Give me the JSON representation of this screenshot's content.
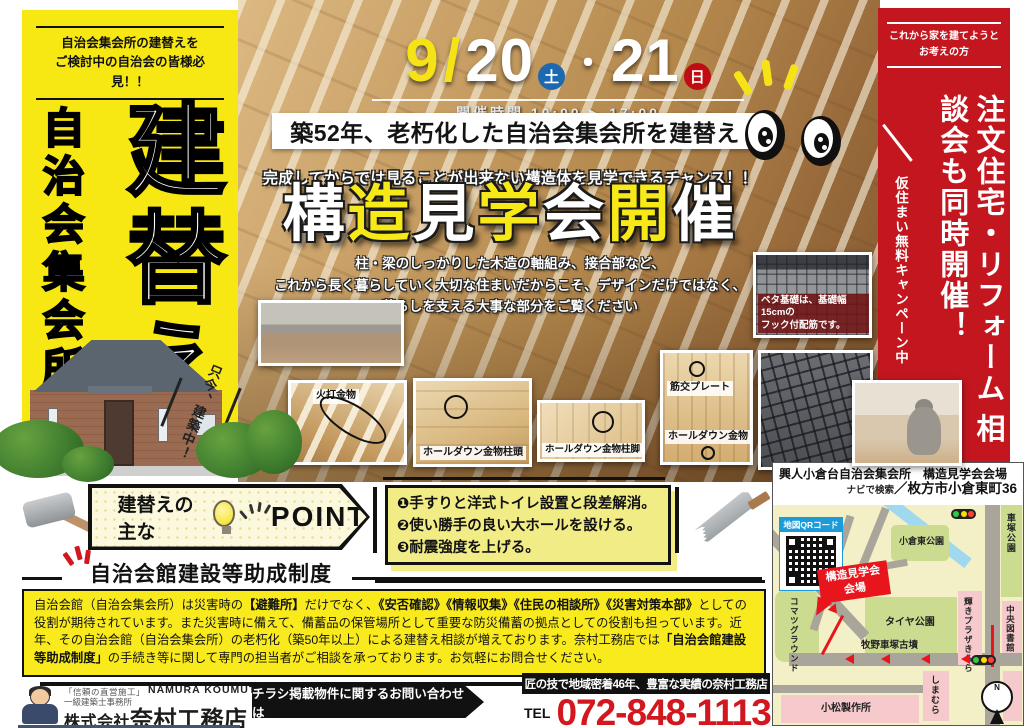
{
  "colors": {
    "banner_yellow": "#F7E814",
    "banner_red": "#C3161F",
    "tel_red": "#D3171E",
    "map_red": "#E8151C",
    "sat_blue": "#1D69B0",
    "sun_red": "#C00D13",
    "title_yellow": "#F7E818"
  },
  "left_banner": {
    "notice_lines": [
      "自治会集会所の建替えを",
      "ご検討中の自治会の皆様必見！！"
    ],
    "vertical_subtitle": "自治会集会所",
    "vertical_title": "建替え",
    "construction_note": "只今、建築中！"
  },
  "event": {
    "month": "9",
    "slash": "/",
    "day1": "20",
    "day1_week": "土",
    "separator": "・",
    "day2": "21",
    "day2_week": "日",
    "time_label": "開催時間",
    "time_value": "10:00 ▶ 17:00",
    "age_banner": "築52年、老朽化した自治会集会所を建替え",
    "chance_line": "完成してからでは見ることが出来ない構造体を見学できるチャンス！！",
    "title_chars": [
      {
        "ch": "構"
      },
      {
        "ch": "造"
      },
      {
        "ch": "見"
      },
      {
        "ch": "学"
      },
      {
        "ch": "会"
      },
      {
        "ch": "開"
      },
      {
        "ch": "催"
      }
    ],
    "description_lines": [
      "柱・梁のしっかりした木造の軸組み、接合部など、",
      "これから長く暮らしていく大切な住まいだからこそ、デザインだけではなく、",
      "暮らしを支える大事な部分をご覧ください"
    ]
  },
  "photos": {
    "hiuchi_caption": "火打金物",
    "holddown_top_caption": "ホールダウン金物柱頭",
    "holddown_base_caption": "ホールダウン金物柱脚",
    "sujikai_caption": "筋交プレート",
    "holddown_caption": "ホールダウン金物",
    "beta_caption_lines": [
      "ベタ基礎は、基礎幅15cmの",
      "フック付配筋です。"
    ]
  },
  "points": {
    "label": "建替えの主な",
    "word": "POINT",
    "items": [
      "❶手すりと洋式トイレ設置と段差解消。",
      "❷使い勝手の良い大ホールを設ける。",
      "❸耐震強度を上げる。"
    ]
  },
  "subsidy": {
    "heading": "自治会館建設等助成制度",
    "body_segments": [
      {
        "text": "自治会館（自治会集会所）は災害時の",
        "bold": false
      },
      {
        "text": "【避難所】",
        "bold": true
      },
      {
        "text": "だけでなく、",
        "bold": false
      },
      {
        "text": "《安否確認》《情報収集》《住民の相談所》《災害対策本部》",
        "bold": true
      },
      {
        "text": "としての役割が期待されています。また災害時に備えて、備蓄品の保管場所として重要な防災備蓄の拠点としての役割も担っています。近年、その自治会館（自治会集会所）の老朽化（築50年以上）による建替え相談が増えております。奈村工務店では",
        "bold": false
      },
      {
        "text": "「自治会館建設等助成制度」",
        "bold": true
      },
      {
        "text": "の手続き等に関して専門の担当者がご相談を承っております。お気軽にお問合せください。",
        "bold": false
      }
    ]
  },
  "right_banner": {
    "audience_lines": [
      "これから家を建てようと",
      "お考えの方"
    ],
    "main_text_1": "注文住宅・リフォーム",
    "main_text_2": "相談会も同時開催！",
    "campaign": "仮住まい無料キャンペーン中"
  },
  "map": {
    "venue_line": "興人小倉台自治会集会所　構造見学会会場",
    "nav_label": "ナビで検索",
    "address": "／枚方市小倉東町36",
    "qr_label": "地図QRコード",
    "venue_box_line1": "構造見学会",
    "venue_box_line2": "会場",
    "compass": "N",
    "labels": {
      "ogura_higashi_park": "小倉東公園",
      "tire_park": "タイヤ公園",
      "kagayaki_plaza": "輝きプラザきらら",
      "kurumazuka_park": "車塚公園",
      "central_library": "中央図書館",
      "komatsu_ground": "コマツグラウンド",
      "makino_kofun": "牧野車塚古墳",
      "shimamura": "しまむら",
      "komatsu_factory": "小松製作所"
    }
  },
  "footer": {
    "slogan_small": "「信頼の直営施工」",
    "company_en": "NAMURA KOUMUTEN",
    "license": "一級建築士事務所",
    "company_prefix": "株式会社",
    "company_name": "奈村工務店",
    "inquiry_ribbon": "チラシ掲載物件に関するお問い合わせは",
    "tagline": "匠の技で地域密着46年、豊富な実績の奈村工務店",
    "tel_label": "TEL",
    "tel_number": "072-848-1113"
  }
}
